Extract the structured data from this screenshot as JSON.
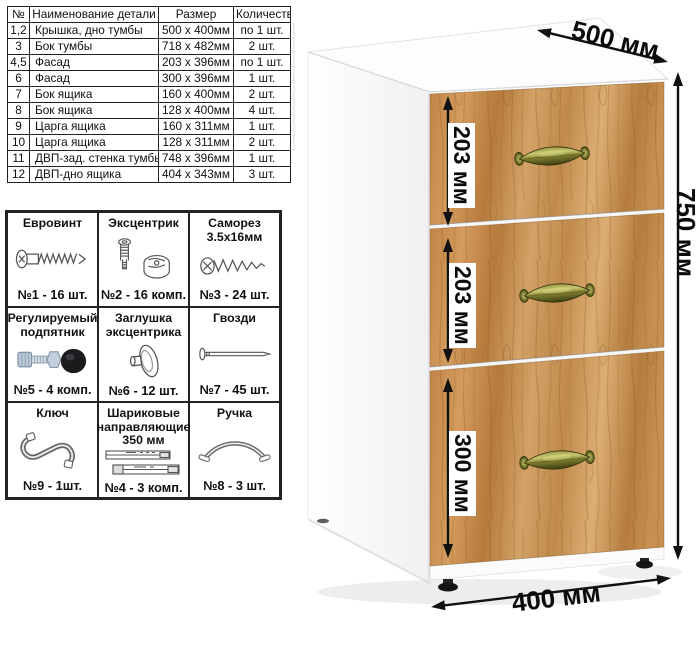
{
  "parts_table": {
    "headers": {
      "num": "№",
      "name": "Наименование детали",
      "size": "Размер",
      "qty": "Количество"
    },
    "rows": [
      {
        "num": "1,2",
        "name": "Крышка, дно тумбы",
        "size": "500 x 400мм",
        "qty": "по 1 шт."
      },
      {
        "num": "3",
        "name": "Бок тумбы",
        "size": "718 x 482мм",
        "qty": "2 шт."
      },
      {
        "num": "4,5",
        "name": "Фасад",
        "size": "203 x 396мм",
        "qty": "по 1 шт."
      },
      {
        "num": "6",
        "name": "Фасад",
        "size": "300 x 396мм",
        "qty": "1 шт."
      },
      {
        "num": "7",
        "name": "Бок ящика",
        "size": "160 x 400мм",
        "qty": "2 шт."
      },
      {
        "num": "8",
        "name": "Бок ящика",
        "size": "128 x 400мм",
        "qty": "4 шт."
      },
      {
        "num": "9",
        "name": "Царга ящика",
        "size": "160 x 311мм",
        "qty": "1 шт."
      },
      {
        "num": "10",
        "name": "Царга ящика",
        "size": "128 x 311мм",
        "qty": "2 шт."
      },
      {
        "num": "11",
        "name": "ДВП-зад. стенка тумбы",
        "size": "748 x 396мм",
        "qty": "1 шт."
      },
      {
        "num": "12",
        "name": "ДВП-дно ящика",
        "size": "404 x 343мм",
        "qty": "3 шт."
      }
    ]
  },
  "hardware": {
    "cells": [
      {
        "title_lines": [
          "Евровинт"
        ],
        "count": "№1 - 16 шт."
      },
      {
        "title_lines": [
          "Эксцентрик"
        ],
        "count": "№2 - 16 комп."
      },
      {
        "title_lines": [
          "Саморез",
          "3.5x16мм"
        ],
        "count": "№3 - 24 шт."
      },
      {
        "title_lines": [
          "Регулируемый",
          "подпятник"
        ],
        "count": "№5 - 4 комп."
      },
      {
        "title_lines": [
          "Заглушка",
          "эксцентрика"
        ],
        "count": "№6 - 12 шт."
      },
      {
        "title_lines": [
          "Гвозди"
        ],
        "count": "№7 - 45 шт."
      },
      {
        "title_lines": [
          "Ключ"
        ],
        "count": "№9 - 1шт."
      },
      {
        "title_lines": [
          "Шариковые",
          "направляющие",
          "350 мм"
        ],
        "count": "№4 - 3 комп."
      },
      {
        "title_lines": [
          "Ручка"
        ],
        "count": "№8 - 3 шт."
      }
    ]
  },
  "dimensions": {
    "depth": "500 мм",
    "height": "750 мм",
    "width": "400 мм",
    "drawer1": "203 мм",
    "drawer2": "203 мм",
    "drawer3": "300 мм"
  },
  "colors": {
    "wood_base": "#c28a4c",
    "wood_light": "#dcae72",
    "wood_dark": "#8a5a28",
    "handle_brass": "#8d8d3a",
    "arrow": "#111111",
    "table_border": "#222222"
  }
}
